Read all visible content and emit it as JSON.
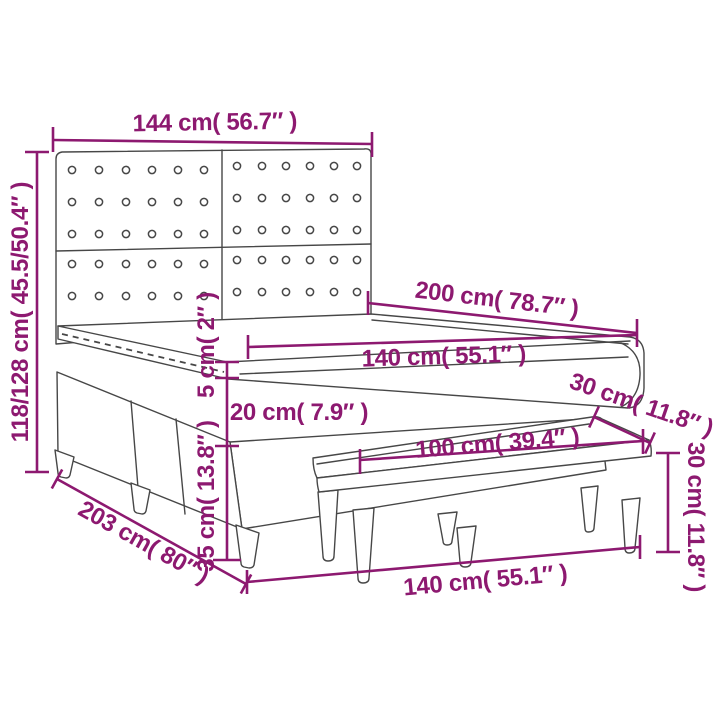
{
  "diagram": {
    "subject": "box-spring-bed-with-headboard-and-bench",
    "colors": {
      "accent": "#8d1970",
      "line": "#474747",
      "background": "#ffffff"
    },
    "annotations": {
      "headboard_width": "144 cm( 56.7″ )",
      "headboard_height": "118/128 cm( 45.5/50.4″ )",
      "bed_length": "200 cm( 78.7″ )",
      "mattress_width": "140 cm( 55.1″ )",
      "topper_thickness": "5 cm( 2″ )",
      "mattress_thickness": "20 cm( 7.9″ )",
      "base_height": "35 cm( 13.8″ )",
      "base_length": "203 cm( 80″ )",
      "bench_length": "100 cm( 39.4″ )",
      "bench_depth": "30 cm( 11.8″ )",
      "bench_height": "30 cm( 11.8″ )",
      "floor_width": "140 cm( 55.1″ )"
    },
    "headboard": {
      "panels": 2,
      "button_columns_per_panel": 6,
      "button_rows_upper": 3,
      "button_rows_lower": 2
    }
  }
}
